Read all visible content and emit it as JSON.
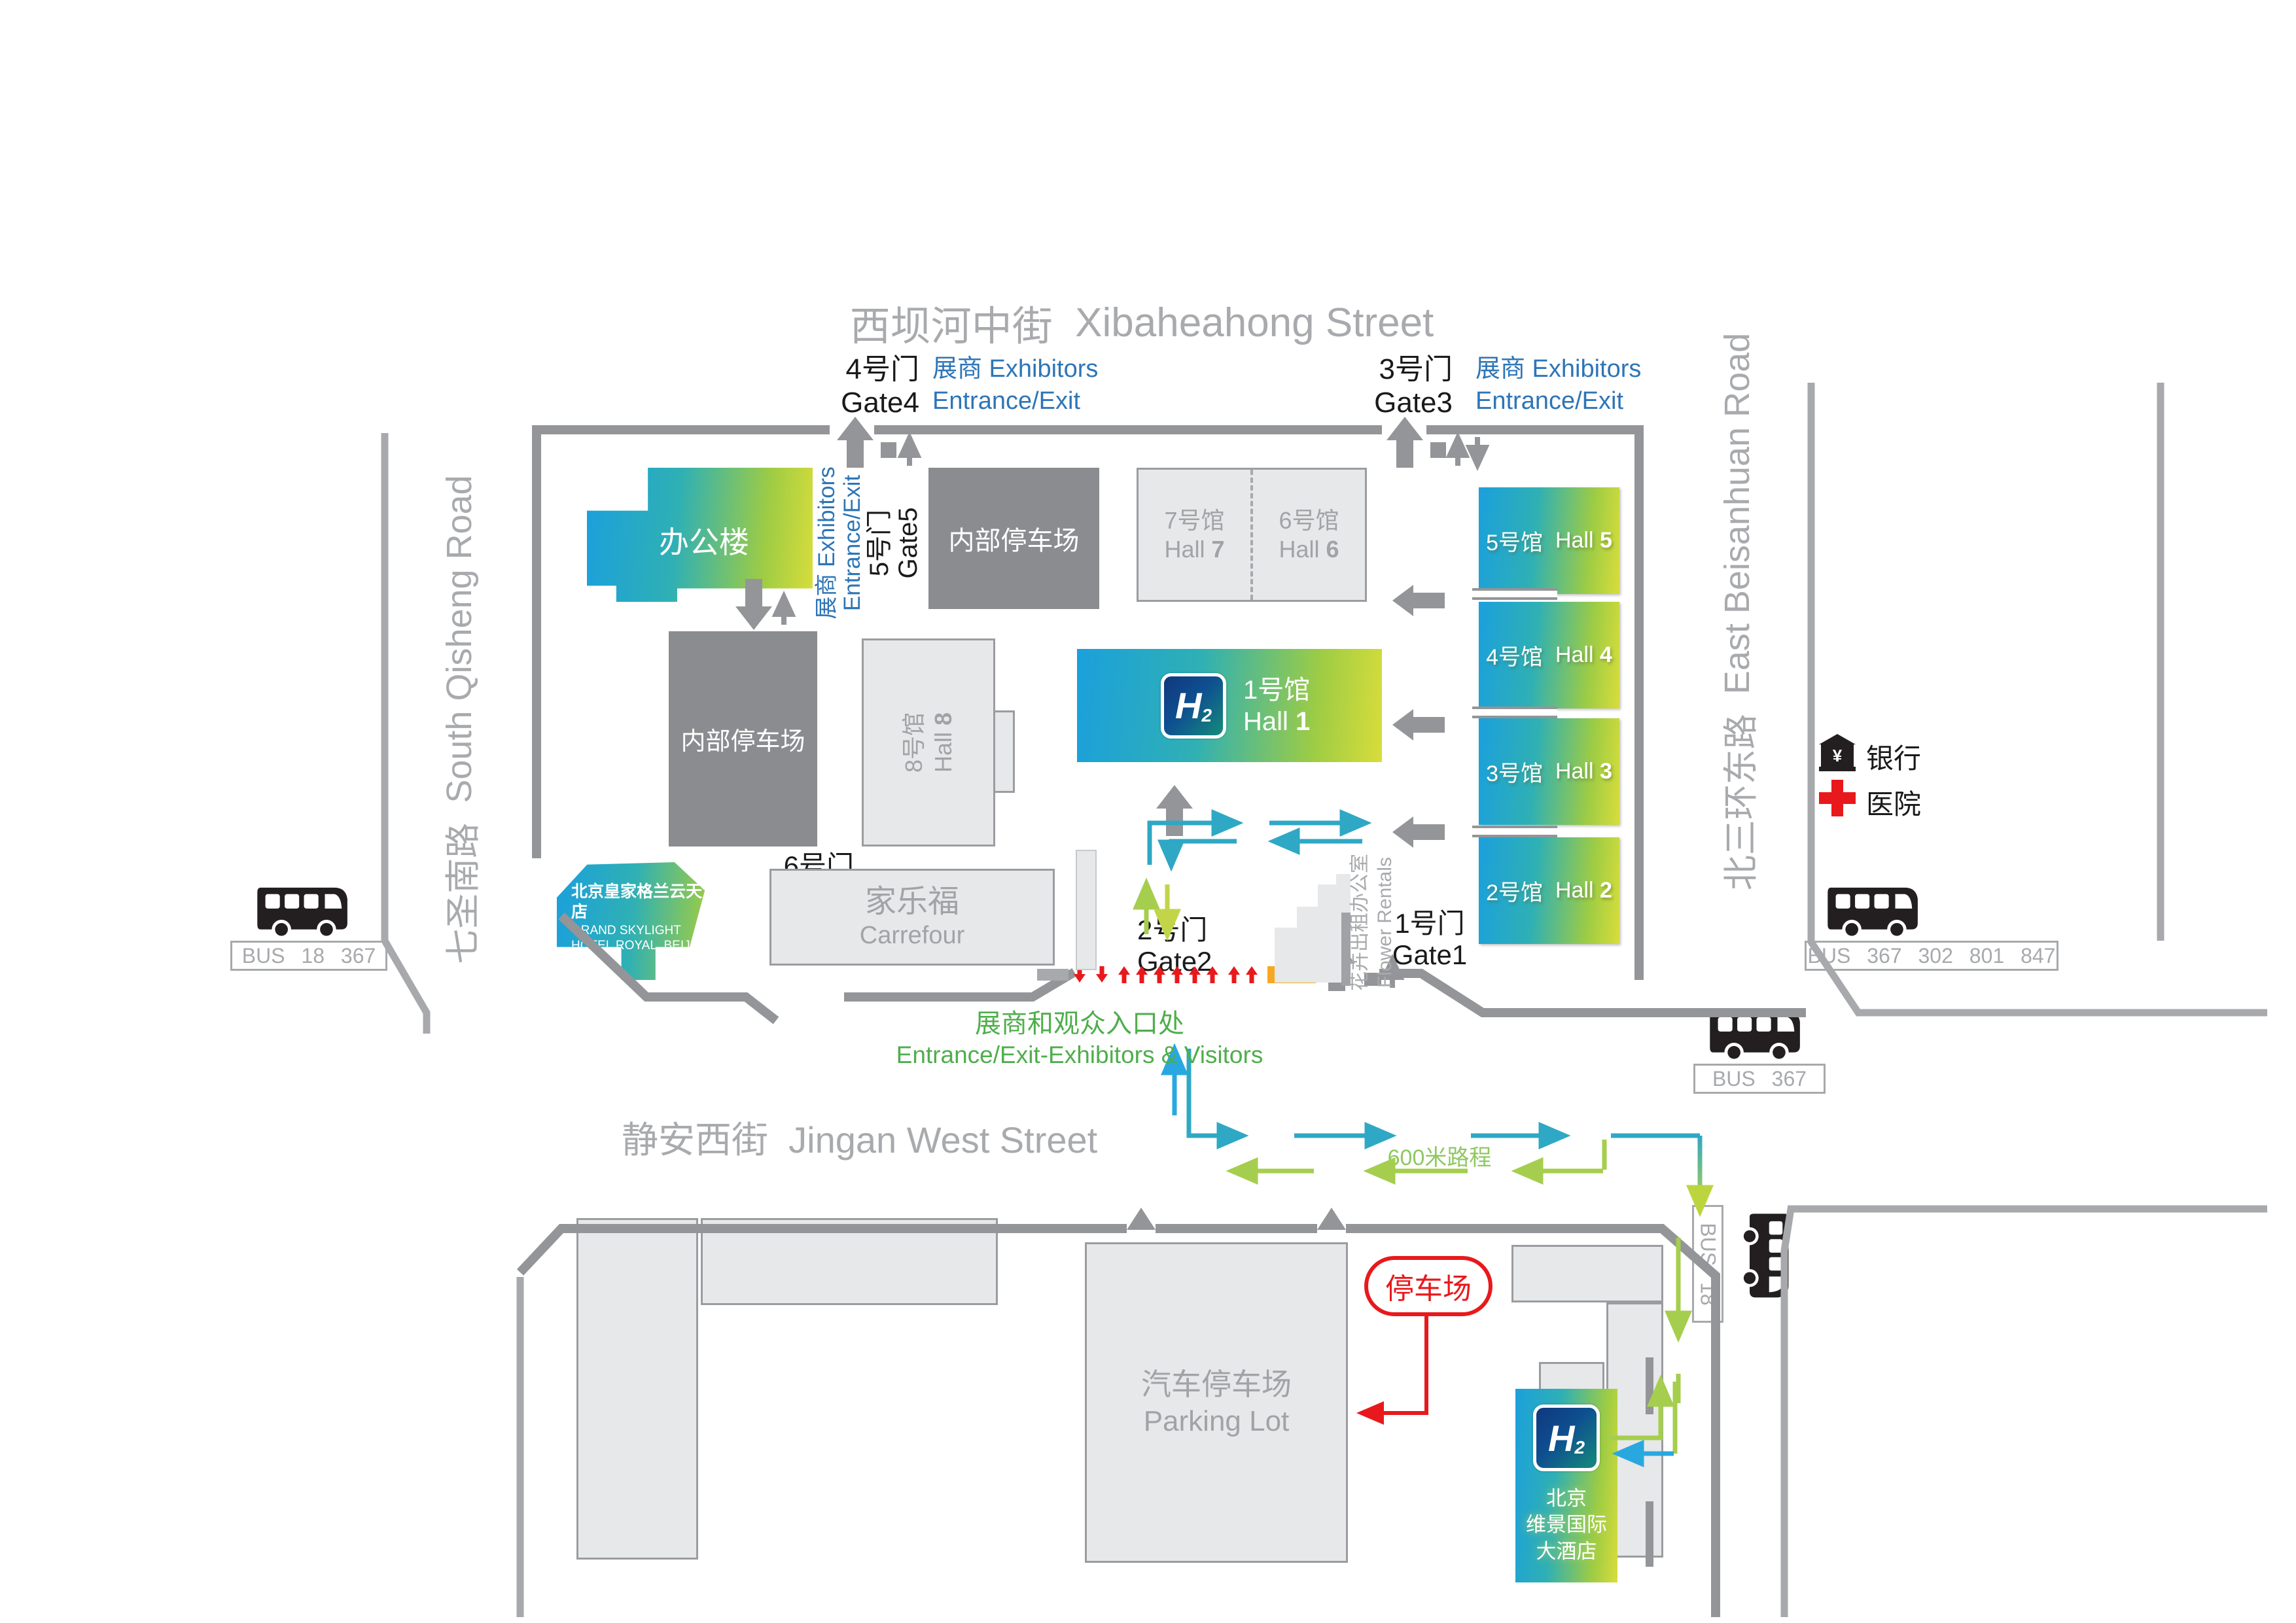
{
  "streets": {
    "top_zh": "西坝河中街",
    "top_en": "Xibaheahong Street",
    "bottom_zh": "静安西街",
    "bottom_en": "Jingan West Street",
    "left_zh": "七圣南路",
    "left_en": "South Qisheng Road",
    "right_zh": "北三环东路",
    "right_en": "East Beisanhuan Road"
  },
  "gates": {
    "g1_zh": "1号门",
    "g1_en": "Gate1",
    "g2_zh": "2号门",
    "g2_en": "Gate2",
    "g3_zh": "3号门",
    "g3_en": "Gate3",
    "g4_zh": "4号门",
    "g4_en": "Gate4",
    "g5_zh": "5号门",
    "g5_en": "Gate5",
    "g6_zh": "6号门",
    "g6_en": "Gate6"
  },
  "exhibitors": {
    "line1": "展商 Exhibitors",
    "line2": "Entrance/Exit"
  },
  "entrance": {
    "zh": "展商和观众入口处",
    "en": "Entrance/Exit-Exhibitors & Visitors"
  },
  "halls": [
    {
      "zh": "1号馆",
      "en": "Hall",
      "num": "1"
    },
    {
      "zh": "2号馆",
      "en": "Hall",
      "num": "2"
    },
    {
      "zh": "3号馆",
      "en": "Hall",
      "num": "3"
    },
    {
      "zh": "4号馆",
      "en": "Hall",
      "num": "4"
    },
    {
      "zh": "5号馆",
      "en": "Hall",
      "num": "5"
    },
    {
      "zh": "6号馆",
      "en": "Hall",
      "num": "6"
    },
    {
      "zh": "7号馆",
      "en": "Hall",
      "num": "7"
    },
    {
      "zh": "8号馆",
      "en": "Hall",
      "num": "8"
    }
  ],
  "buildings": {
    "office": "办公楼",
    "inner_parking_north": "内部停车场",
    "inner_parking_west": "内部停车场",
    "carrefour_zh": "家乐福",
    "carrefour_en": "Carrefour",
    "flower_zh": "花卉出租办公室",
    "flower_en": "Flower Rentals",
    "grand_skylight_zh": "北京皇家格兰云天大酒店",
    "grand_skylight_en1": "GRAND SKYLIGHT",
    "grand_skylight_en2": "HOTEL ROYAL, BEIJING",
    "parking_zh": "汽车停车场",
    "parking_en": "Parking Lot",
    "hotel_h2_line1": "北京",
    "hotel_h2_line2": "维景国际",
    "hotel_h2_line3": "大酒店"
  },
  "poi": {
    "bank": "银行",
    "hospital": "医院"
  },
  "bus_stops": {
    "west": "BUS 18 367",
    "east": "BUS 367 302 801 847",
    "southeast": "BUS 367",
    "south": "BUS 18"
  },
  "annotations": {
    "distance": "600米路程",
    "parking_callout": "停车场"
  },
  "logo": {
    "letter": "H",
    "sub": "2"
  },
  "colors": {
    "hall_gradient_start": "#1BA0DC",
    "hall_gradient_end": "#D8DD3B",
    "exhibitor_blue": "#2E75B6",
    "entrance_green": "#4FAE4C",
    "teal_arrow": "#2FA8C5",
    "green_arrow": "#A5CE4E",
    "red": "#E8191C",
    "orange": "#F7A823",
    "dark_gray": "#8A8C8F",
    "boundary_gray": "#939598"
  }
}
